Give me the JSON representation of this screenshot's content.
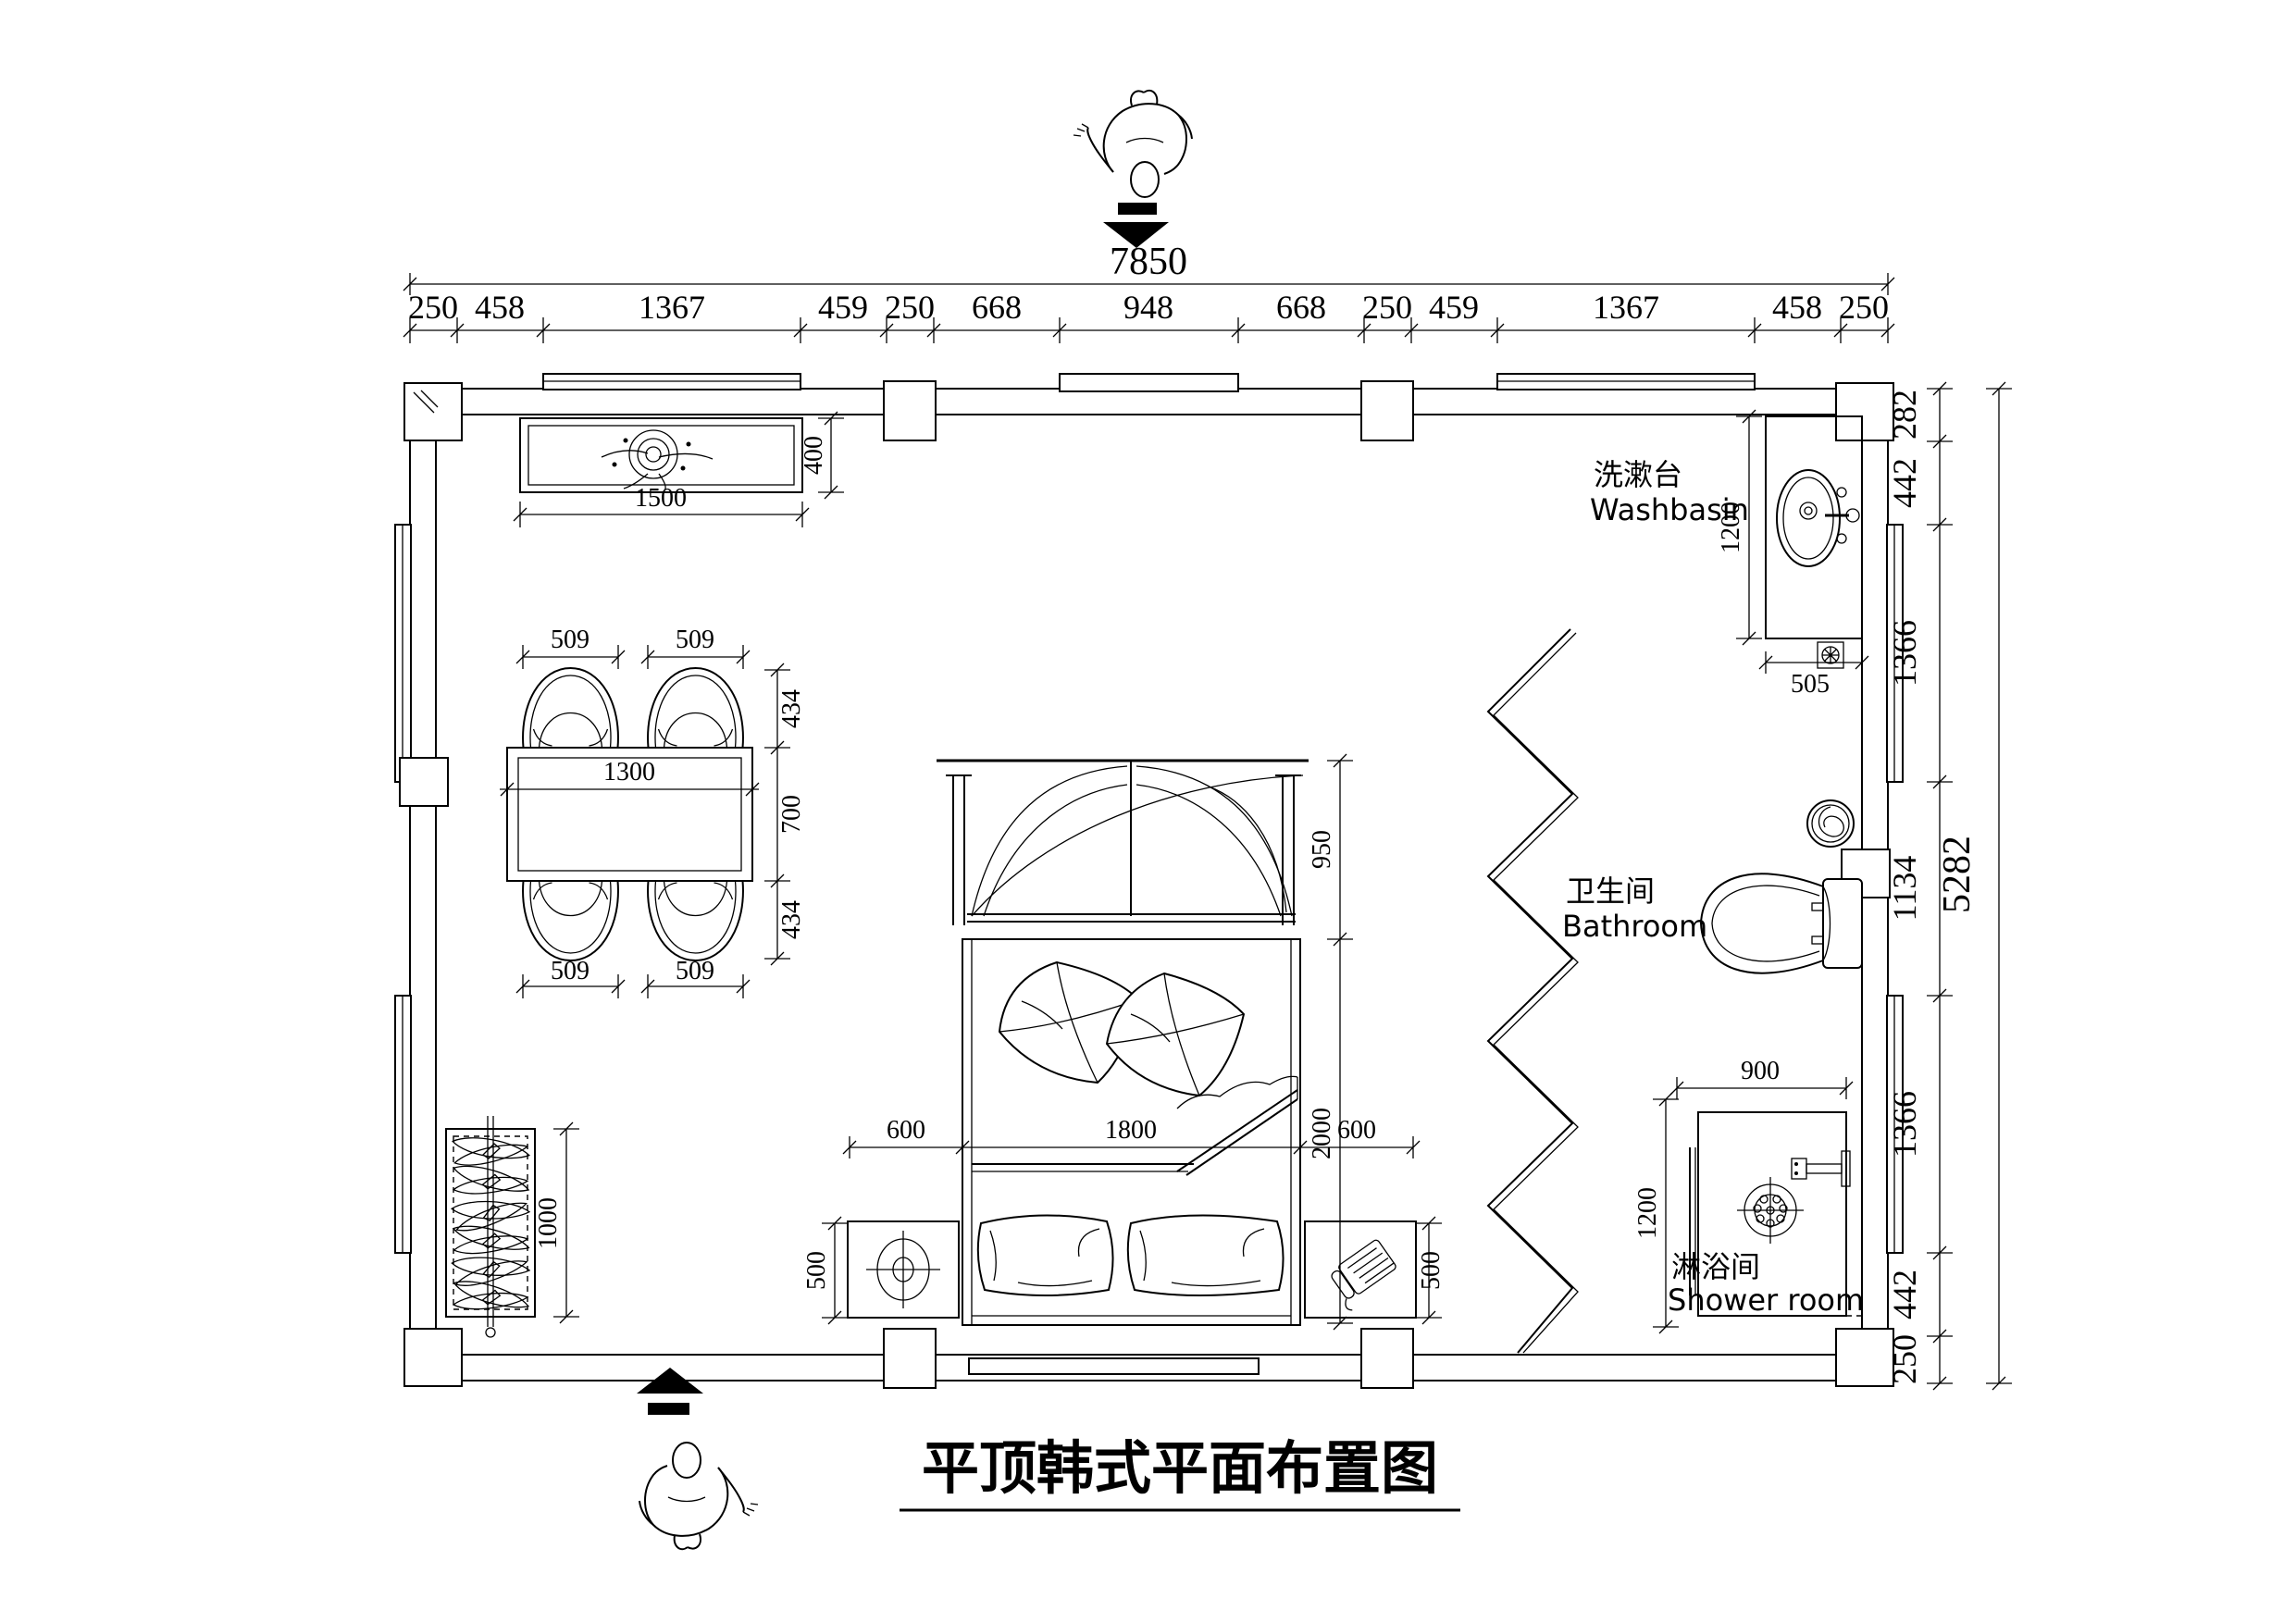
{
  "title": "平顶韩式平面布置图",
  "dimensions": {
    "top_total": "7850",
    "top_segments": [
      "250",
      "458",
      "1367",
      "459",
      "250",
      "668",
      "948",
      "668",
      "250",
      "459",
      "1367",
      "458",
      "250"
    ],
    "right_total": "5282",
    "right_segments": [
      "282",
      "442",
      "1366",
      "1134",
      "1366",
      "442",
      "250"
    ]
  },
  "furniture": {
    "console": {
      "width": "1500",
      "depth": "400"
    },
    "dining": {
      "chair_width": "509",
      "table_width": "1300",
      "chair_depth": "434",
      "table_depth": "700"
    },
    "bed": {
      "canopy_depth": "950",
      "length": "2000",
      "side_left": "600",
      "width": "1800",
      "side_right": "600",
      "nightstand_depth": "500"
    },
    "wardrobe": {
      "length": "1000"
    },
    "washbasin_counter": {
      "length": "1200",
      "width": "505"
    },
    "shower": {
      "width": "900",
      "depth": "1200"
    }
  },
  "labels": {
    "washbasin_zh": "洗漱台",
    "washbasin_en": "Washbasin",
    "bathroom_zh": "卫生间",
    "bathroom_en": "Bathroom",
    "shower_zh": "淋浴间",
    "shower_en": "Shower room"
  },
  "colors": {
    "ink": "#000000",
    "paper": "#ffffff"
  }
}
